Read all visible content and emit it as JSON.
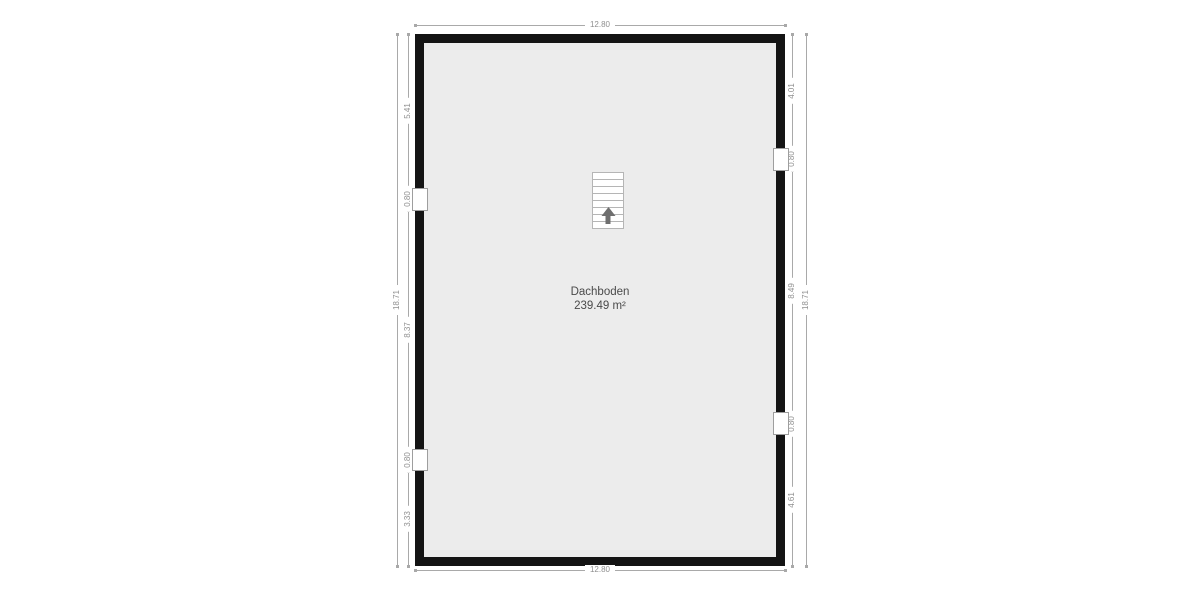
{
  "room": {
    "name": "Dachboden",
    "area": "239.49 m²"
  },
  "dimensions": {
    "top_total": "12.80",
    "bottom_total": "12.80",
    "left_total": "18.71",
    "right_total": "18.71",
    "left_segments": [
      {
        "value": "5.41",
        "window": false
      },
      {
        "value": "0.80",
        "window": true
      },
      {
        "value": "8.37",
        "window": false
      },
      {
        "value": "0.80",
        "window": true
      },
      {
        "value": "3.33",
        "window": false
      }
    ],
    "right_segments": [
      {
        "value": "4.01",
        "window": false
      },
      {
        "value": "0.80",
        "window": true
      },
      {
        "value": "8.49",
        "window": false
      },
      {
        "value": "0.80",
        "window": true
      },
      {
        "value": "4.61",
        "window": false
      }
    ]
  },
  "stairs": {
    "steps": 8,
    "direction": "up"
  },
  "colors": {
    "wall": "#141414",
    "floor": "#ececec",
    "dim_line": "#a9a9a9",
    "dim_text": "#8f8f8f",
    "room_text": "#4a4a4a",
    "window_border": "#9e9e9e",
    "stairs_border": "#b5b5b5",
    "arrow": "#6f6f6f"
  }
}
